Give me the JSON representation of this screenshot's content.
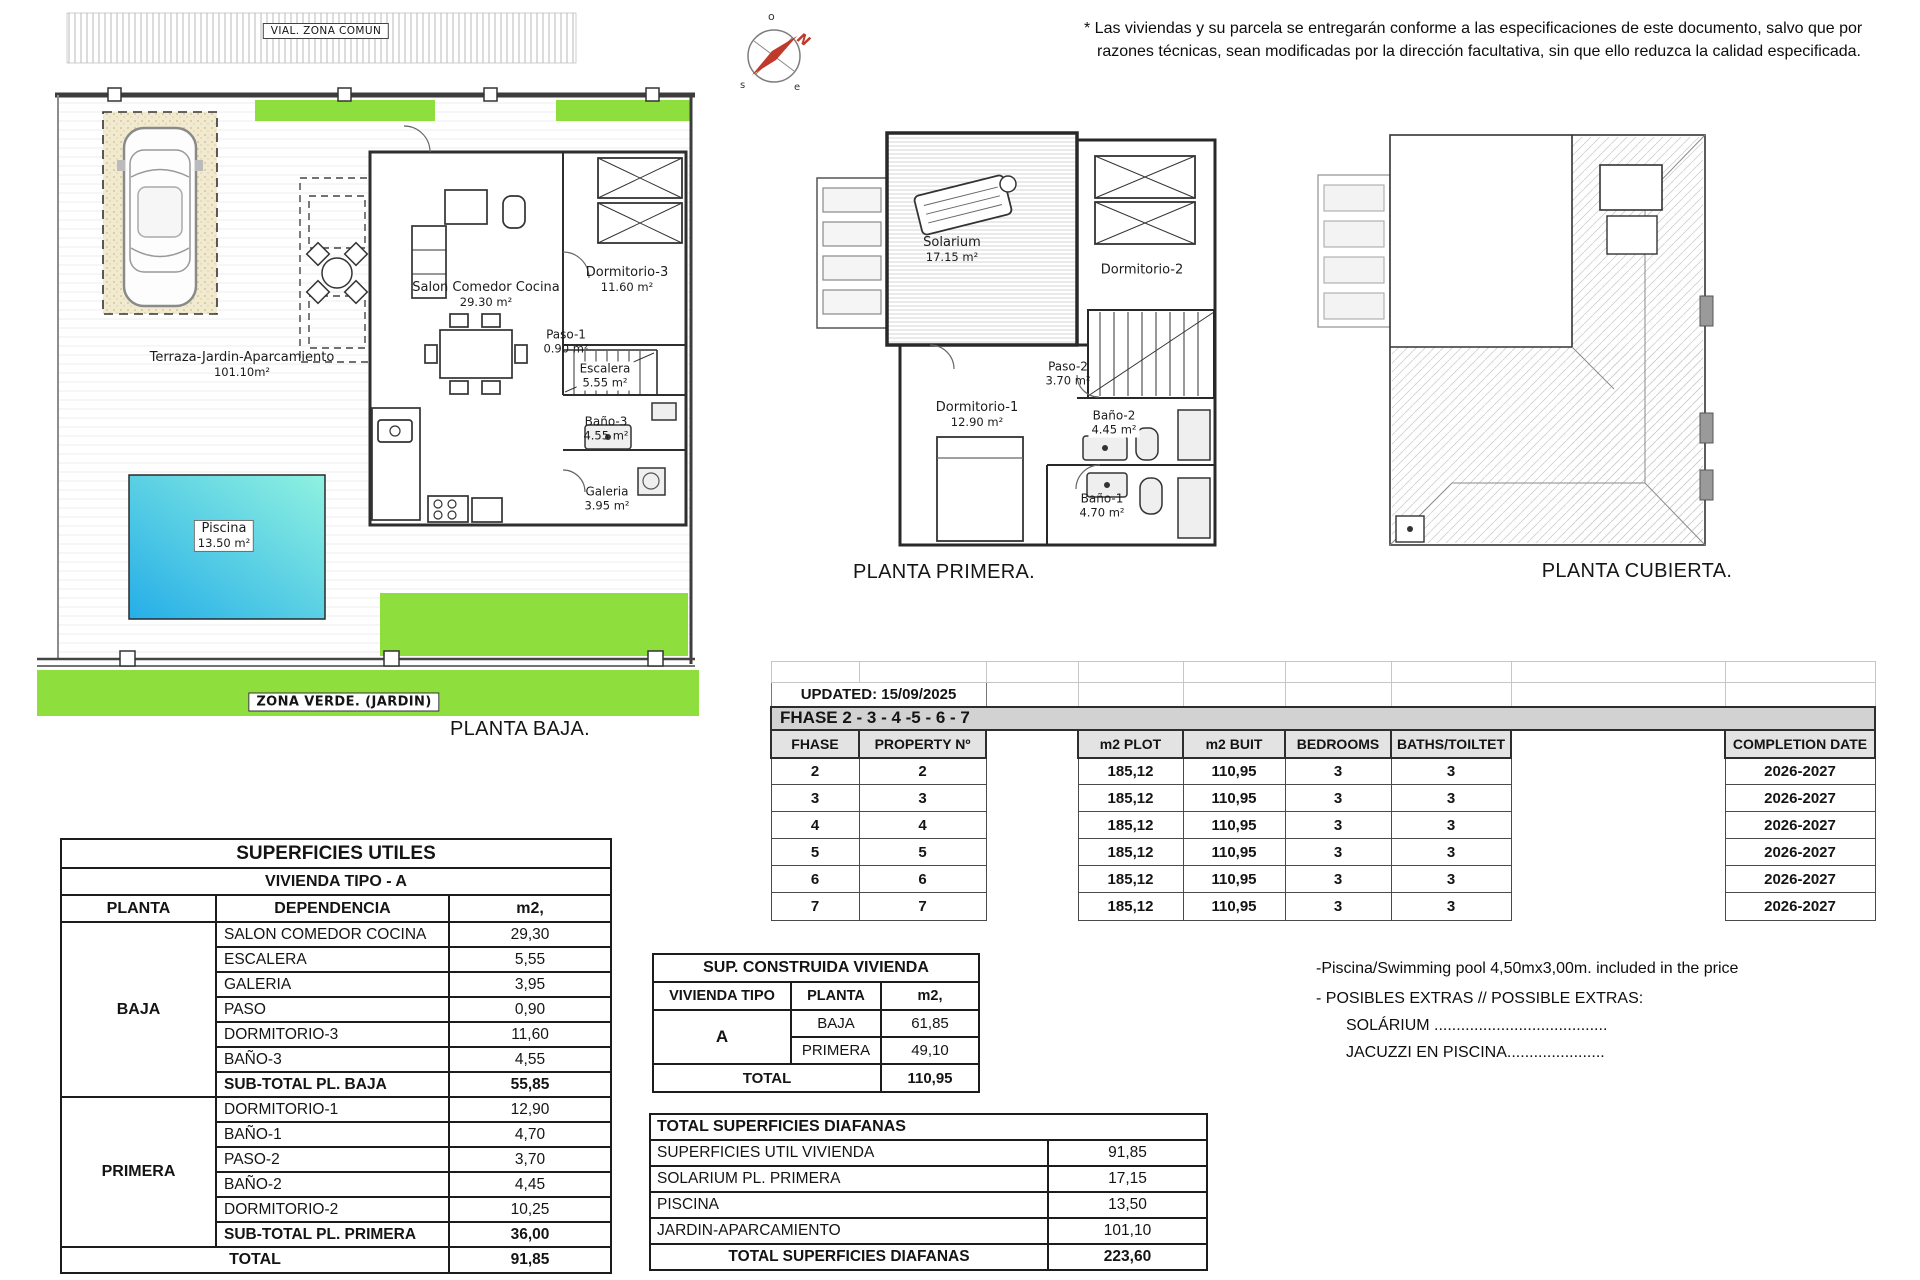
{
  "disclaimer": {
    "line1": "* Las viviendas y su parcela se entregarán conforme a las especificaciones de este documento, salvo que por",
    "line2": "razones técnicas, sean modificadas por la dirección facultativa, sin que ello reduzca la calidad especificada."
  },
  "site": {
    "vial_label": "VIAL. ZONA COMUN",
    "zona_verde_label": "ZONA VERDE. (JARDIN)"
  },
  "plans": {
    "baja": {
      "title": "PLANTA BAJA.",
      "terraza": {
        "name": "Terraza-Jardin-Aparcamiento",
        "area": "101.10m²"
      },
      "piscina": {
        "name": "Piscina",
        "area": "13.50 m²"
      },
      "salon": {
        "name": "Salon Comedor Cocina",
        "area": "29.30 m²"
      },
      "dormitorio3": {
        "name": "Dormitorio-3",
        "area": "11.60 m²"
      },
      "paso1": {
        "name": "Paso-1",
        "area": "0.90 m²"
      },
      "escalera": {
        "name": "Escalera",
        "area": "5.55 m²"
      },
      "bano3": {
        "name": "Baño-3",
        "area": "4.55 m²"
      },
      "galeria": {
        "name": "Galeria",
        "area": "3.95 m²"
      }
    },
    "primera": {
      "title": "PLANTA PRIMERA.",
      "solarium": {
        "name": "Solarium",
        "area": "17.15 m²"
      },
      "dormitorio2": {
        "name": "Dormitorio-2",
        "area": "10.25 m²"
      },
      "paso2": {
        "name": "Paso-2",
        "area": "3.70 m²"
      },
      "dormitorio1": {
        "name": "Dormitorio-1",
        "area": "12.90 m²"
      },
      "bano2": {
        "name": "Baño-2",
        "area": "4.45 m²"
      },
      "bano1": {
        "name": "Baño-1",
        "area": "4.70 m²"
      }
    },
    "cubierta": {
      "title": "PLANTA CUBIERTA."
    }
  },
  "phase_table": {
    "updated": "UPDATED: 15/09/2025",
    "band": "FHASE  2 - 3 - 4 -5 - 6 - 7",
    "headers": {
      "fhase": "FHASE",
      "property": "PROPERTY Nº",
      "plot": "m2 PLOT",
      "built": "m2 BUIT",
      "bedrooms": "BEDROOMS",
      "baths": "BATHS/TOILTET",
      "completion": "COMPLETION DATE"
    },
    "rows": [
      {
        "fhase": "2",
        "property": "2",
        "plot": "185,12",
        "built": "110,95",
        "bedrooms": "3",
        "baths": "3",
        "completion": "2026-2027"
      },
      {
        "fhase": "3",
        "property": "3",
        "plot": "185,12",
        "built": "110,95",
        "bedrooms": "3",
        "baths": "3",
        "completion": "2026-2027"
      },
      {
        "fhase": "4",
        "property": "4",
        "plot": "185,12",
        "built": "110,95",
        "bedrooms": "3",
        "baths": "3",
        "completion": "2026-2027"
      },
      {
        "fhase": "5",
        "property": "5",
        "plot": "185,12",
        "built": "110,95",
        "bedrooms": "3",
        "baths": "3",
        "completion": "2026-2027"
      },
      {
        "fhase": "6",
        "property": "6",
        "plot": "185,12",
        "built": "110,95",
        "bedrooms": "3",
        "baths": "3",
        "completion": "2026-2027"
      },
      {
        "fhase": "7",
        "property": "7",
        "plot": "185,12",
        "built": "110,95",
        "bedrooms": "3",
        "baths": "3",
        "completion": "2026-2027"
      }
    ]
  },
  "superficies_utiles": {
    "title": "SUPERFICIES UTILES",
    "subtitle": "VIVIENDA TIPO - A",
    "headers": {
      "planta": "PLANTA",
      "dependencia": "DEPENDENCIA",
      "m2": "m2,"
    },
    "baja_label": "BAJA",
    "primera_label": "PRIMERA",
    "baja_rows": [
      {
        "label": "SALON COMEDOR COCINA",
        "value": "29,30"
      },
      {
        "label": "ESCALERA",
        "value": "5,55"
      },
      {
        "label": "GALERIA",
        "value": "3,95"
      },
      {
        "label": "PASO",
        "value": "0,90"
      },
      {
        "label": "DORMITORIO-3",
        "value": "11,60"
      },
      {
        "label": "BAÑO-3",
        "value": "4,55"
      }
    ],
    "baja_subtotal": {
      "label": "SUB-TOTAL PL. BAJA",
      "value": "55,85"
    },
    "primera_rows": [
      {
        "label": "DORMITORIO-1",
        "value": "12,90"
      },
      {
        "label": "BAÑO-1",
        "value": "4,70"
      },
      {
        "label": "PASO-2",
        "value": "3,70"
      },
      {
        "label": "BAÑO-2",
        "value": "4,45"
      },
      {
        "label": "DORMITORIO-2",
        "value": "10,25"
      }
    ],
    "primera_subtotal": {
      "label": "SUB-TOTAL PL. PRIMERA",
      "value": "36,00"
    },
    "total": {
      "label": "TOTAL",
      "value": "91,85"
    }
  },
  "sup_construida": {
    "title": "SUP. CONSTRUIDA VIVIENDA",
    "headers": {
      "tipo": "VIVIENDA TIPO",
      "planta": "PLANTA",
      "m2": "m2,"
    },
    "tipo": "A",
    "rows": [
      {
        "label": "BAJA",
        "value": "61,85"
      },
      {
        "label": "PRIMERA",
        "value": "49,10"
      }
    ],
    "total": {
      "label": "TOTAL",
      "value": "110,95"
    }
  },
  "diafanas": {
    "title": "TOTAL SUPERFICIES DIAFANAS",
    "rows": [
      {
        "label": "SUPERFICIES UTIL VIVIENDA",
        "value": "91,85"
      },
      {
        "label": "SOLARIUM PL. PRIMERA",
        "value": "17,15"
      },
      {
        "label": "PISCINA",
        "value": "13,50"
      },
      {
        "label": "JARDIN-APARCAMIENTO",
        "value": "101,10"
      }
    ],
    "total": {
      "label": "TOTAL SUPERFICIES DIAFANAS",
      "value": "223,60"
    }
  },
  "notes": {
    "pool": "-Piscina/Swimming pool 4,50mx3,00m. included in the price",
    "extras": "- POSIBLES EXTRAS // POSSIBLE EXTRAS:",
    "solarium": "SOLÁRIUM .......................................",
    "jacuzzi": "JACUZZI EN PISCINA......................"
  },
  "colors": {
    "garden_green": "#8ede3e",
    "pool_blue": "#25aee8",
    "pool_cyan": "#90f2e0",
    "sand": "#f1ead0",
    "table_band_gray": "#d2d2d2",
    "compass_red": "#c0392b"
  }
}
